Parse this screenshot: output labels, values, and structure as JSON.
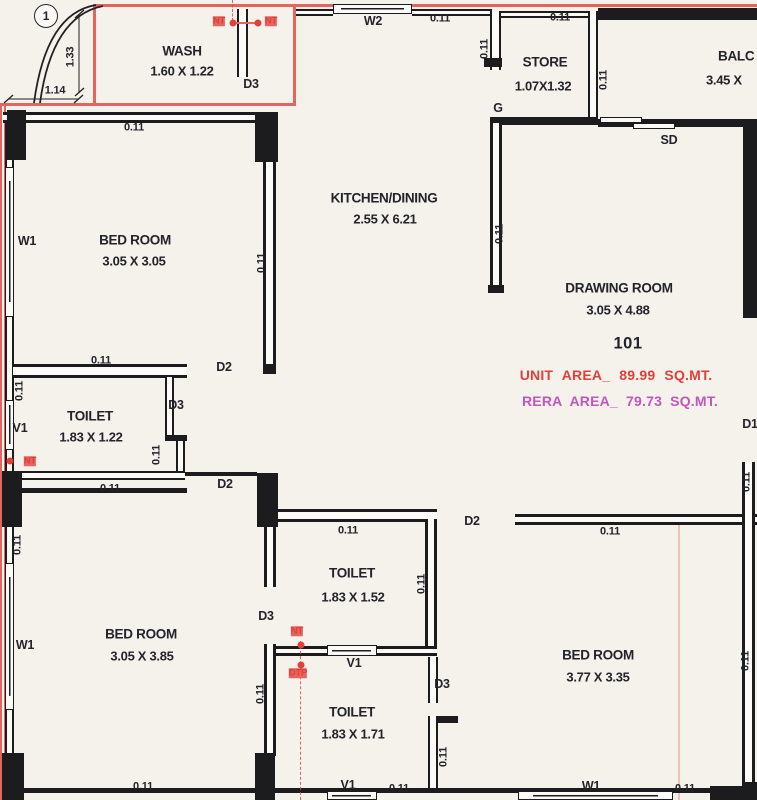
{
  "unit": {
    "number": "101",
    "unit_area": "UNIT AREA_ 89.99 SQ.MT.",
    "rera_area": "RERA AREA_ 79.73 SQ.MT."
  },
  "rooms": [
    {
      "id": "wash",
      "name": "WASH",
      "dims": "1.60 X 1.22"
    },
    {
      "id": "store",
      "name": "STORE",
      "dims": "1.07X1.32"
    },
    {
      "id": "balcony",
      "name": "BALC",
      "dims": "3.45 X"
    },
    {
      "id": "kitchen-dining",
      "name": "KITCHEN/DINING",
      "dims": "2.55 X 6.21"
    },
    {
      "id": "drawing-room",
      "name": "DRAWING ROOM",
      "dims": "3.05 X 4.88"
    },
    {
      "id": "bed-room-1",
      "name": "BED ROOM",
      "dims": "3.05 X 3.05"
    },
    {
      "id": "toilet-1",
      "name": "TOILET",
      "dims": "1.83 X 1.22"
    },
    {
      "id": "bed-room-2",
      "name": "BED ROOM",
      "dims": "3.05 X 3.85"
    },
    {
      "id": "toilet-2",
      "name": "TOILET",
      "dims": "1.83 X 1.52"
    },
    {
      "id": "toilet-3",
      "name": "TOILET",
      "dims": "1.83 X 1.71"
    },
    {
      "id": "bed-room-3",
      "name": "BED ROOM",
      "dims": "3.77 X 3.35"
    }
  ],
  "annotations": [
    {
      "t": "1",
      "x": 46,
      "y": 16,
      "cls": "circled",
      "n": "column-marker"
    },
    {
      "t": "1.33",
      "x": 71,
      "y": 57,
      "cls": "rot",
      "n": "dimension-label"
    },
    {
      "t": "1.14",
      "x": 55,
      "y": 91,
      "n": "dimension-label"
    },
    {
      "t": "NT",
      "x": 219,
      "y": 21,
      "cls": "red",
      "n": "plumbing-label"
    },
    {
      "t": "NT",
      "x": 271,
      "y": 21,
      "cls": "red",
      "n": "plumbing-label"
    },
    {
      "t": "D3",
      "x": 251,
      "y": 84,
      "cls": "big",
      "n": "door-label"
    },
    {
      "t": "W2",
      "x": 373,
      "y": 21,
      "cls": "big",
      "n": "window-label"
    },
    {
      "t": "0.11",
      "x": 440,
      "y": 19,
      "n": "dim-label"
    },
    {
      "t": "0.11",
      "x": 485,
      "y": 49,
      "cls": "rot",
      "n": "dim-label"
    },
    {
      "t": "0.11",
      "x": 560,
      "y": 18,
      "n": "dim-label"
    },
    {
      "t": "G",
      "x": 498,
      "y": 108,
      "cls": "big",
      "n": "door-label"
    },
    {
      "t": "0.11",
      "x": 604,
      "y": 80,
      "cls": "rot",
      "n": "dim-label"
    },
    {
      "t": "SD",
      "x": 669,
      "y": 140,
      "cls": "big",
      "n": "door-label"
    },
    {
      "t": "0.11",
      "x": 134,
      "y": 128,
      "n": "dim-label"
    },
    {
      "t": "W1",
      "x": 27,
      "y": 241,
      "cls": "big",
      "n": "window-label"
    },
    {
      "t": "0.11",
      "x": 262,
      "y": 263,
      "cls": "rot",
      "n": "dim-label"
    },
    {
      "t": "0.11",
      "x": 500,
      "y": 234,
      "cls": "rot",
      "n": "dim-label"
    },
    {
      "t": "0.11",
      "x": 101,
      "y": 361,
      "n": "dim-label"
    },
    {
      "t": "D2",
      "x": 224,
      "y": 367,
      "cls": "big",
      "n": "door-label"
    },
    {
      "t": "0.11",
      "x": 20,
      "y": 391,
      "cls": "rot",
      "n": "dim-label"
    },
    {
      "t": "V1",
      "x": 20,
      "y": 428,
      "cls": "big",
      "n": "window-label"
    },
    {
      "t": "D3",
      "x": 176,
      "y": 405,
      "cls": "big",
      "n": "door-label"
    },
    {
      "t": "0.11",
      "x": 157,
      "y": 455,
      "cls": "rot",
      "n": "dim-label"
    },
    {
      "t": "NT",
      "x": 30,
      "y": 461,
      "cls": "red",
      "n": "plumbing-label"
    },
    {
      "t": "0.11",
      "x": 110,
      "y": 489,
      "n": "dim-label"
    },
    {
      "t": "D2",
      "x": 225,
      "y": 484,
      "cls": "big",
      "n": "door-label"
    },
    {
      "t": "D1",
      "x": 750,
      "y": 424,
      "cls": "big",
      "n": "door-label"
    },
    {
      "t": "0.11",
      "x": 747,
      "y": 482,
      "cls": "rot",
      "n": "dim-label"
    },
    {
      "t": "0.11",
      "x": 18,
      "y": 545,
      "cls": "rot",
      "n": "dim-label"
    },
    {
      "t": "0.11",
      "x": 348,
      "y": 531,
      "n": "dim-label"
    },
    {
      "t": "D2",
      "x": 472,
      "y": 521,
      "cls": "big",
      "n": "door-label"
    },
    {
      "t": "0.11",
      "x": 610,
      "y": 532,
      "n": "dim-label"
    },
    {
      "t": "0.11",
      "x": 422,
      "y": 584,
      "cls": "rot",
      "n": "dim-label"
    },
    {
      "t": "D3",
      "x": 266,
      "y": 616,
      "cls": "big",
      "n": "door-label"
    },
    {
      "t": "NT",
      "x": 297,
      "y": 631,
      "cls": "red",
      "n": "plumbing-label"
    },
    {
      "t": "DTP",
      "x": 298,
      "y": 673,
      "cls": "red",
      "n": "plumbing-label"
    },
    {
      "t": "V1",
      "x": 354,
      "y": 663,
      "cls": "big",
      "n": "window-label"
    },
    {
      "t": "W1",
      "x": 25,
      "y": 645,
      "cls": "big",
      "n": "window-label"
    },
    {
      "t": "0.11",
      "x": 261,
      "y": 694,
      "cls": "rot",
      "n": "dim-label"
    },
    {
      "t": "D3",
      "x": 442,
      "y": 684,
      "cls": "big",
      "n": "door-label"
    },
    {
      "t": "0.11",
      "x": 444,
      "y": 757,
      "cls": "rot",
      "n": "dim-label"
    },
    {
      "t": "0.11",
      "x": 746,
      "y": 661,
      "cls": "rot",
      "n": "dim-label"
    },
    {
      "t": "0.11",
      "x": 143,
      "y": 787,
      "n": "dim-label"
    },
    {
      "t": "V1",
      "x": 348,
      "y": 785,
      "cls": "big",
      "n": "window-label"
    },
    {
      "t": "0.11",
      "x": 399,
      "y": 789,
      "n": "dim-label"
    },
    {
      "t": "W1",
      "x": 591,
      "y": 786,
      "cls": "big",
      "n": "window-label"
    },
    {
      "t": "0.11",
      "x": 685,
      "y": 789,
      "n": "dim-label"
    }
  ],
  "colors": {
    "wall": "#1c1c1e",
    "paper": "#f5f2ec",
    "boundary": "#e4645e",
    "accentRed": "#e23f38",
    "accentMagenta": "#c355be",
    "ink": "#23232b"
  }
}
